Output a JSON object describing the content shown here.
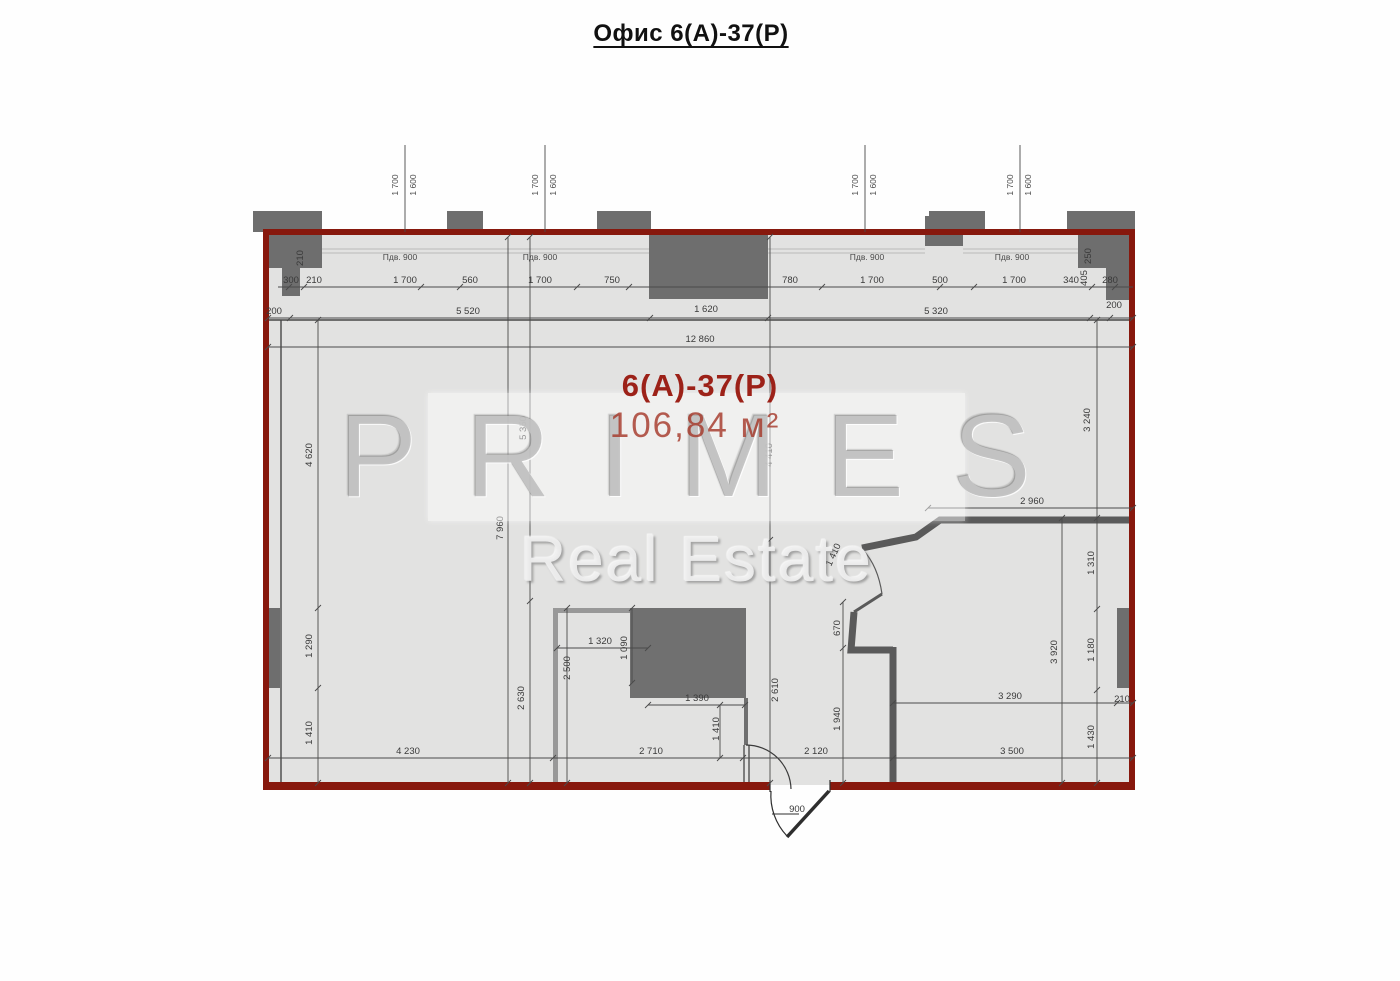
{
  "title": "Офис 6(А)-37(Р)",
  "room": {
    "label": "6(А)-37(Р)",
    "area": "106,84 м²"
  },
  "watermark": {
    "line1": "PRIMES",
    "line2": "Real Estate"
  },
  "plan": {
    "accent_color": "#87180d",
    "wall_color": "#6e6e6e",
    "floor_color": "#e2e2e1",
    "door_swing_label": "900",
    "dimension_labels": [
      {
        "t": "300",
        "x": 291,
        "y": 283
      },
      {
        "t": "210",
        "x": 314,
        "y": 283
      },
      {
        "t": "210",
        "x": 303,
        "y": 258,
        "r": -90
      },
      {
        "t": "1 700",
        "x": 405,
        "y": 283
      },
      {
        "t": "560",
        "x": 470,
        "y": 283
      },
      {
        "t": "1 700",
        "x": 540,
        "y": 283
      },
      {
        "t": "750",
        "x": 612,
        "y": 283
      },
      {
        "t": "780",
        "x": 790,
        "y": 283
      },
      {
        "t": "1 700",
        "x": 872,
        "y": 283
      },
      {
        "t": "500",
        "x": 940,
        "y": 283
      },
      {
        "t": "1 700",
        "x": 1014,
        "y": 283
      },
      {
        "t": "340",
        "x": 1071,
        "y": 283
      },
      {
        "t": "405",
        "x": 1087,
        "y": 278,
        "r": -90
      },
      {
        "t": "280",
        "x": 1110,
        "y": 283
      },
      {
        "t": "250",
        "x": 1091,
        "y": 256,
        "r": -90
      },
      {
        "t": "200",
        "x": 1114,
        "y": 308
      },
      {
        "t": "200",
        "x": 274,
        "y": 314
      },
      {
        "t": "5 520",
        "x": 468,
        "y": 314
      },
      {
        "t": "1 620",
        "x": 706,
        "y": 312
      },
      {
        "t": "5 320",
        "x": 936,
        "y": 314
      },
      {
        "t": "12 860",
        "x": 700,
        "y": 342
      },
      {
        "t": "Пдв. 900",
        "x": 400,
        "y": 260,
        "s": "sill"
      },
      {
        "t": "Пдв. 900",
        "x": 540,
        "y": 260,
        "s": "sill"
      },
      {
        "t": "Пдв. 900",
        "x": 867,
        "y": 260,
        "s": "sill"
      },
      {
        "t": "Пдв. 900",
        "x": 1012,
        "y": 260,
        "s": "sill"
      },
      {
        "t": "1 700",
        "x": 398,
        "y": 185,
        "r": -90,
        "s": "wm"
      },
      {
        "t": "1 600",
        "x": 416,
        "y": 185,
        "r": -90,
        "s": "wm"
      },
      {
        "t": "1 700",
        "x": 538,
        "y": 185,
        "r": -90,
        "s": "wm"
      },
      {
        "t": "1 600",
        "x": 556,
        "y": 185,
        "r": -90,
        "s": "wm"
      },
      {
        "t": "1 700",
        "x": 858,
        "y": 185,
        "r": -90,
        "s": "wm"
      },
      {
        "t": "1 600",
        "x": 876,
        "y": 185,
        "r": -90,
        "s": "wm"
      },
      {
        "t": "1 700",
        "x": 1013,
        "y": 185,
        "r": -90,
        "s": "wm"
      },
      {
        "t": "1 600",
        "x": 1031,
        "y": 185,
        "r": -90,
        "s": "wm"
      },
      {
        "t": "4 620",
        "x": 312,
        "y": 455,
        "r": -90
      },
      {
        "t": "1 290",
        "x": 312,
        "y": 646,
        "r": -90
      },
      {
        "t": "1 410",
        "x": 312,
        "y": 733,
        "r": -90
      },
      {
        "t": "7 960",
        "x": 503,
        "y": 528,
        "r": -90
      },
      {
        "t": "5 350",
        "x": 526,
        "y": 428,
        "r": -90
      },
      {
        "t": "2 630",
        "x": 524,
        "y": 698,
        "r": -90
      },
      {
        "t": "2 500",
        "x": 570,
        "y": 668,
        "r": -90
      },
      {
        "t": "1 090",
        "x": 627,
        "y": 648,
        "r": -90
      },
      {
        "t": "1 320",
        "x": 600,
        "y": 644
      },
      {
        "t": "1 390",
        "x": 697,
        "y": 701
      },
      {
        "t": "4 410",
        "x": 772,
        "y": 455,
        "r": -90
      },
      {
        "t": "2 610",
        "x": 778,
        "y": 690,
        "r": -90
      },
      {
        "t": "1 410",
        "x": 719,
        "y": 729,
        "r": -90
      },
      {
        "t": "670",
        "x": 840,
        "y": 628,
        "r": -90
      },
      {
        "t": "1 940",
        "x": 840,
        "y": 719,
        "r": -90
      },
      {
        "t": "1 410",
        "x": 836,
        "y": 556,
        "r": -65
      },
      {
        "t": "3 920",
        "x": 1057,
        "y": 652,
        "r": -90
      },
      {
        "t": "3 240",
        "x": 1090,
        "y": 420,
        "r": -90
      },
      {
        "t": "1 310",
        "x": 1094,
        "y": 563,
        "r": -90
      },
      {
        "t": "1 180",
        "x": 1094,
        "y": 650,
        "r": -90
      },
      {
        "t": "1 430",
        "x": 1094,
        "y": 737,
        "r": -90
      },
      {
        "t": "4 230",
        "x": 408,
        "y": 754
      },
      {
        "t": "2 710",
        "x": 651,
        "y": 754
      },
      {
        "t": "2 120",
        "x": 816,
        "y": 754
      },
      {
        "t": "3 500",
        "x": 1012,
        "y": 754
      },
      {
        "t": "3 290",
        "x": 1010,
        "y": 699
      },
      {
        "t": "210",
        "x": 1122,
        "y": 702
      },
      {
        "t": "2 960",
        "x": 1032,
        "y": 504
      },
      {
        "t": "900",
        "x": 797,
        "y": 812
      }
    ]
  }
}
